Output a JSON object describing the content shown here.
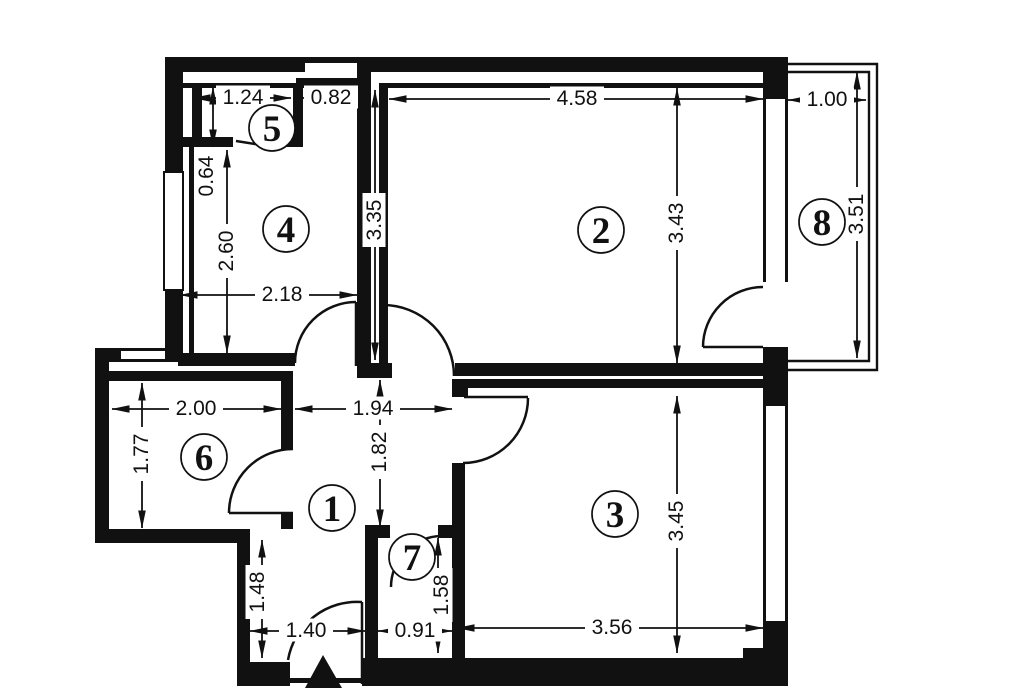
{
  "meta": {
    "title": "apartment-floor-plan",
    "width": 1024,
    "height": 688,
    "background_color": "#ffffff",
    "ink_color": "#111111"
  },
  "rooms": [
    {
      "number": "1",
      "cx": 332,
      "cy": 508
    },
    {
      "number": "2",
      "cx": 601,
      "cy": 230
    },
    {
      "number": "3",
      "cx": 615,
      "cy": 514
    },
    {
      "number": "4",
      "cx": 286,
      "cy": 229
    },
    {
      "number": "5",
      "cx": 272,
      "cy": 128
    },
    {
      "number": "6",
      "cx": 204,
      "cy": 457
    },
    {
      "number": "7",
      "cx": 412,
      "cy": 557
    },
    {
      "number": "8",
      "cx": 822,
      "cy": 222
    }
  ],
  "circle_radius": 23,
  "dimensions": [
    {
      "text": "1.24",
      "x1": 193,
      "y1": 98,
      "x2": 291,
      "y2": 98,
      "lx": 243,
      "ly": 97,
      "rot": 0
    },
    {
      "text": "0.82",
      "x1": 303,
      "y1": 98,
      "x2": 357,
      "y2": 98,
      "lx": 331,
      "ly": 97,
      "rot": 0
    },
    {
      "text": "4.58",
      "x1": 389,
      "y1": 99,
      "x2": 763,
      "y2": 99,
      "lx": 577,
      "ly": 98,
      "rot": 0
    },
    {
      "text": "1.00",
      "x1": 788,
      "y1": 100,
      "x2": 866,
      "y2": 100,
      "lx": 827,
      "ly": 99,
      "rot": 0
    },
    {
      "text": "0.64",
      "x1": 213,
      "y1": 87,
      "x2": 213,
      "y2": 147,
      "lx": 206,
      "ly": 176,
      "rot": -90
    },
    {
      "text": "2.60",
      "x1": 227,
      "y1": 150,
      "x2": 227,
      "y2": 353,
      "lx": 226,
      "ly": 251,
      "rot": -90
    },
    {
      "text": "2.18",
      "x1": 180,
      "y1": 295,
      "x2": 357,
      "y2": 295,
      "lx": 282,
      "ly": 294,
      "rot": 0
    },
    {
      "text": "3.35",
      "x1": 375,
      "y1": 90,
      "x2": 375,
      "y2": 360,
      "lx": 374,
      "ly": 220,
      "rot": -90
    },
    {
      "text": "3.43",
      "x1": 677,
      "y1": 88,
      "x2": 677,
      "y2": 363,
      "lx": 676,
      "ly": 223,
      "rot": -90
    },
    {
      "text": "3.51",
      "x1": 857,
      "y1": 72,
      "x2": 857,
      "y2": 358,
      "lx": 856,
      "ly": 214,
      "rot": -90
    },
    {
      "text": "2.00",
      "x1": 112,
      "y1": 409,
      "x2": 281,
      "y2": 409,
      "lx": 196,
      "ly": 408,
      "rot": 0
    },
    {
      "text": "1.94",
      "x1": 295,
      "y1": 409,
      "x2": 452,
      "y2": 409,
      "lx": 373,
      "ly": 408,
      "rot": 0
    },
    {
      "text": "1.77",
      "x1": 142,
      "y1": 383,
      "x2": 142,
      "y2": 528,
      "lx": 141,
      "ly": 454,
      "rot": -90
    },
    {
      "text": "1.82",
      "x1": 380,
      "y1": 380,
      "x2": 380,
      "y2": 527,
      "lx": 379,
      "ly": 452,
      "rot": -90
    },
    {
      "text": "1.48",
      "x1": 262,
      "y1": 540,
      "x2": 262,
      "y2": 658,
      "lx": 257,
      "ly": 592,
      "rot": -90
    },
    {
      "text": "1.58",
      "x1": 438,
      "y1": 538,
      "x2": 438,
      "y2": 653,
      "lx": 441,
      "ly": 595,
      "rot": -90
    },
    {
      "text": "1.40",
      "x1": 250,
      "y1": 631,
      "x2": 365,
      "y2": 631,
      "lx": 306,
      "ly": 630,
      "rot": 0
    },
    {
      "text": "0.91",
      "x1": 378,
      "y1": 631,
      "x2": 452,
      "y2": 631,
      "lx": 415,
      "ly": 630,
      "rot": 0
    },
    {
      "text": "3.56",
      "x1": 457,
      "y1": 628,
      "x2": 763,
      "y2": 628,
      "lx": 612,
      "ly": 627,
      "rot": 0
    },
    {
      "text": "3.45",
      "x1": 677,
      "y1": 396,
      "x2": 677,
      "y2": 653,
      "lx": 676,
      "ly": 521,
      "rot": -90
    }
  ],
  "walls": [
    [
      165,
      57,
      140,
      15
    ],
    [
      305,
      57,
      62,
      6
    ],
    [
      367,
      57,
      421,
      15
    ],
    [
      296,
      78,
      74,
      10
    ],
    [
      172,
      83,
      121,
      5
    ],
    [
      385,
      83,
      378,
      5
    ],
    [
      165,
      57,
      18,
      117
    ],
    [
      165,
      288,
      18,
      65
    ],
    [
      189,
      147,
      5,
      206
    ],
    [
      192,
      83,
      10,
      64
    ],
    [
      180,
      137,
      53,
      10
    ],
    [
      283,
      137,
      20,
      10
    ],
    [
      293,
      83,
      10,
      64
    ],
    [
      178,
      353,
      117,
      13
    ],
    [
      357,
      63,
      14,
      303
    ],
    [
      379,
      83,
      9,
      280
    ],
    [
      357,
      363,
      35,
      15
    ],
    [
      455,
      363,
      308,
      13
    ],
    [
      462,
      379,
      301,
      9
    ],
    [
      452,
      379,
      16,
      18
    ],
    [
      452,
      463,
      13,
      210
    ],
    [
      95,
      348,
      85,
      14
    ],
    [
      95,
      348,
      14,
      195
    ],
    [
      95,
      529,
      155,
      14
    ],
    [
      237,
      529,
      13,
      157
    ],
    [
      109,
      371,
      184,
      10
    ],
    [
      281,
      381,
      12,
      68
    ],
    [
      281,
      513,
      12,
      16
    ],
    [
      365,
      525,
      13,
      143
    ],
    [
      365,
      525,
      25,
      13
    ],
    [
      438,
      525,
      25,
      13
    ],
    [
      237,
      662,
      53,
      24
    ],
    [
      362,
      658,
      401,
      28
    ],
    [
      743,
      648,
      20,
      10
    ],
    [
      763,
      57,
      25,
      629
    ],
    [
      290,
      678,
      72,
      5
    ]
  ],
  "windows": [
    [
      164,
      172,
      19,
      118
    ],
    [
      120,
      350,
      46,
      10
    ],
    [
      765,
      98,
      21,
      185
    ],
    [
      765,
      405,
      21,
      217
    ]
  ],
  "openings": [
    [
      763,
      282,
      25,
      65
    ]
  ],
  "parapet_paths": [
    "M788,64 H877 V370 H788",
    "M788,72 H869 V361 H788"
  ],
  "door_arcs": [
    "M295,363 A61,61 0 0 1 356,302",
    "M383,305 A71,71 0 0 1 454,376",
    "M528,398 A65,65 0 0 1 463,463",
    "M229,513 A64,64 0 0 1 293,449",
    "M391,587 A51,51 0 0 1 441,536",
    "M288,660 A70,70 0 0 1 362,602",
    "M703,347 A60,60 0 0 1 763,287"
  ],
  "door_leaves": [
    [
      356,
      302,
      356,
      366
    ],
    [
      383,
      308,
      383,
      363
    ],
    [
      464,
      397,
      528,
      397
    ],
    [
      229,
      513,
      293,
      513
    ],
    [
      362,
      602,
      362,
      684
    ],
    [
      703,
      347,
      763,
      347
    ],
    [
      236,
      141,
      281,
      148
    ]
  ],
  "entrance_triangle": "305,688 342,688 323,655"
}
